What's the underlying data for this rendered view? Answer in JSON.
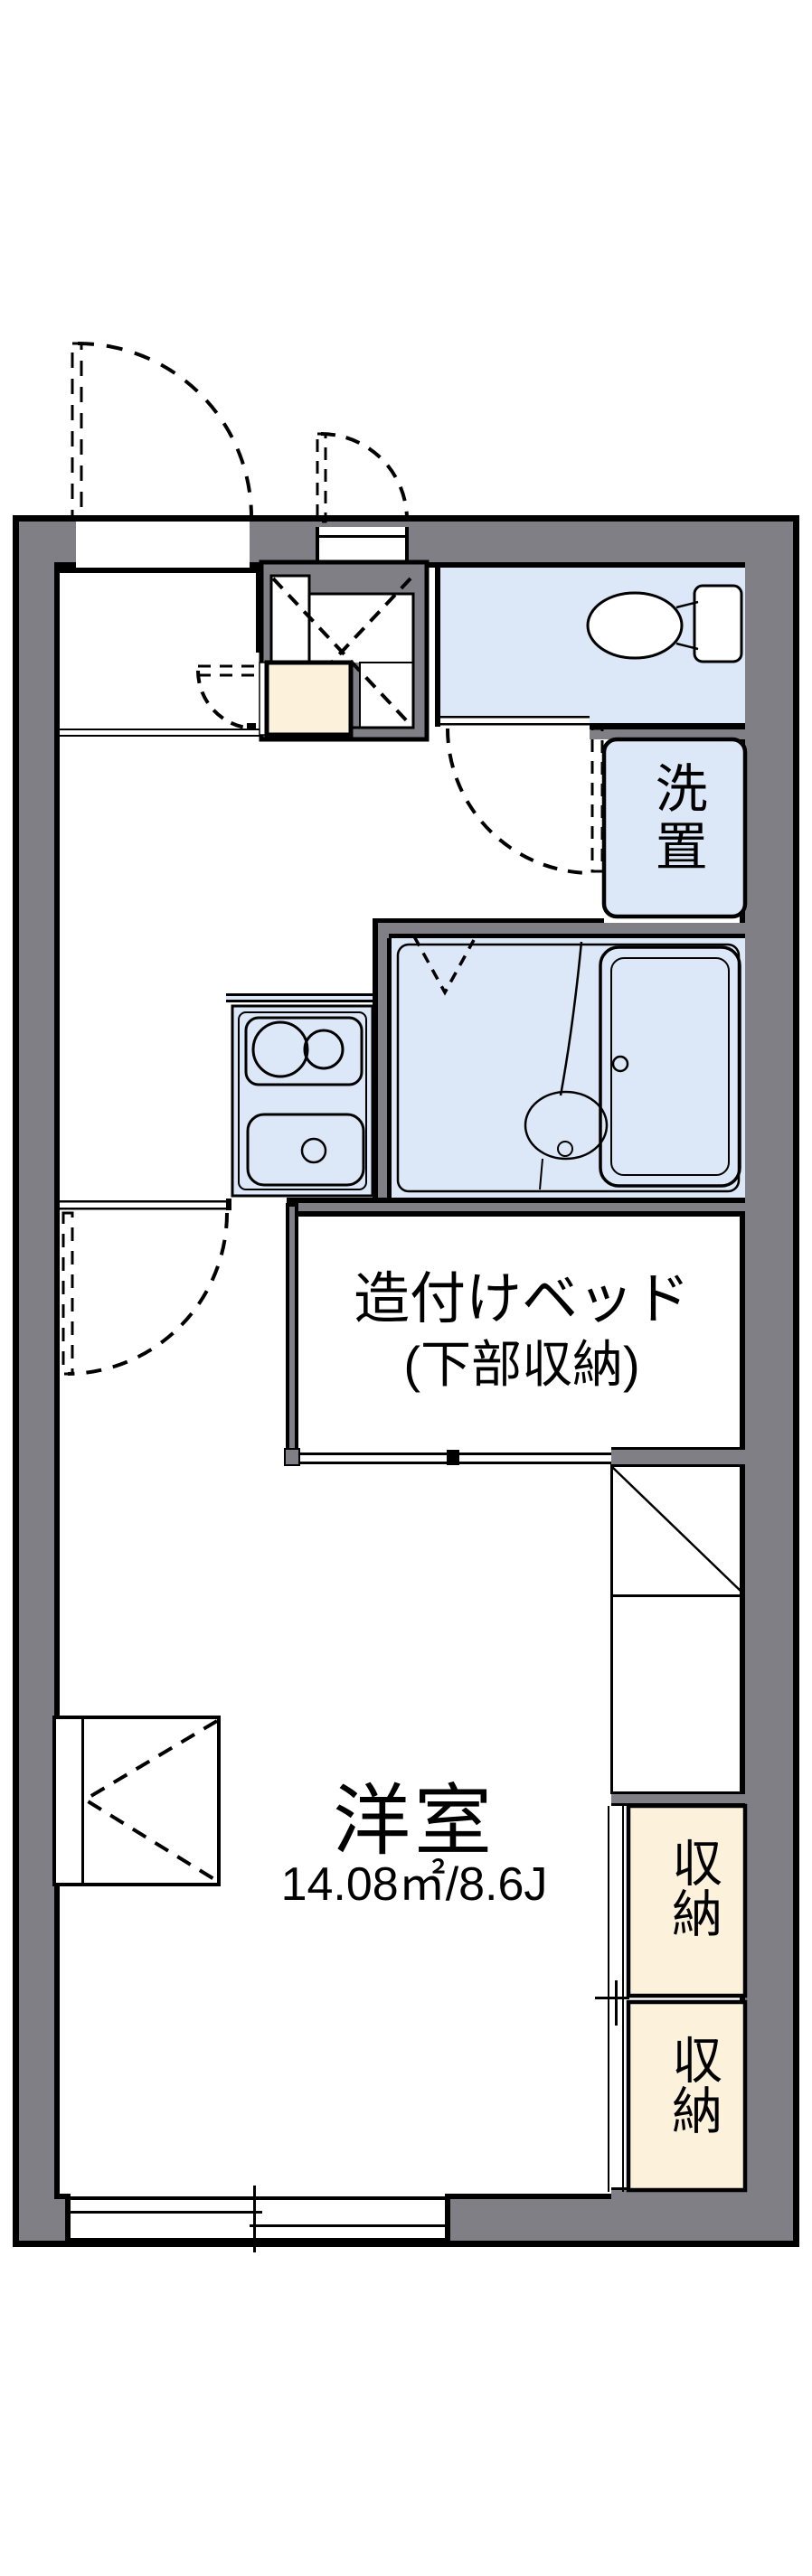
{
  "plan": {
    "type": "apartment-floorplan",
    "labels": {
      "laundry": "洗置",
      "bed_line1": "造付けベッド",
      "bed_line2": "(下部収納)",
      "room_name": "洋室",
      "room_area": "14.08㎡/8.6J",
      "storage_upper": "収納",
      "storage_lower": "収納"
    },
    "rooms": [
      {
        "name": "toilet",
        "fill": "#dce8f7"
      },
      {
        "name": "laundry-space",
        "fill": "#dce8f7"
      },
      {
        "name": "bathroom",
        "fill": "#dce8f7"
      },
      {
        "name": "kitchen-unit",
        "fill": "#dce8f7"
      },
      {
        "name": "built-in-bed",
        "fill": "#ffffff"
      },
      {
        "name": "western-room",
        "fill": "#ffffff"
      },
      {
        "name": "storage-upper",
        "fill": "#fcf2dc"
      },
      {
        "name": "storage-lower",
        "fill": "#fcf2dc"
      },
      {
        "name": "shoe-cabinet",
        "fill": "#fcf2dc"
      }
    ],
    "colors": {
      "wall_gray": "#7f7f85",
      "line_black": "#000000",
      "room_blue": "#dce8f7",
      "cream": "#fcf2dc",
      "background": "#ffffff"
    },
    "icons": [
      "toilet-icon",
      "bathtub-icon",
      "bath-drain-icon",
      "stove-icon",
      "kitchen-sink-icon",
      "door-swing-arc",
      "sliding-window-symbol",
      "duct-cross-icon",
      "closet-diagonal-icon",
      "folding-door-icon"
    ]
  }
}
